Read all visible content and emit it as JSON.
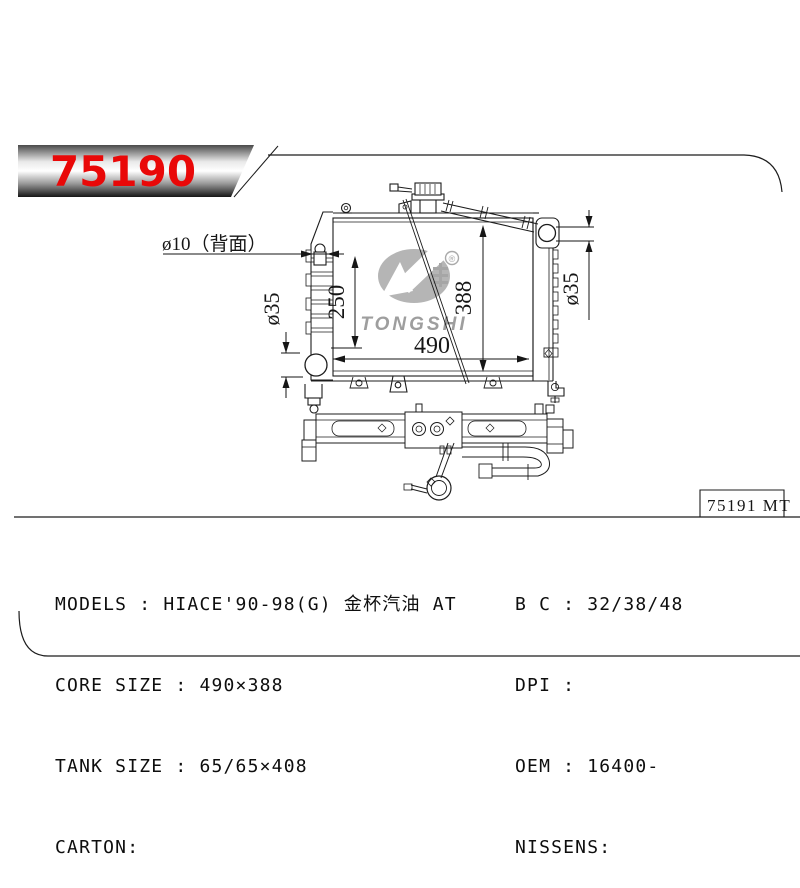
{
  "banner": {
    "part_number": "75190",
    "text_color": "#e90808"
  },
  "front_view": {
    "dimensions": {
      "rear_hole": "ø10（背面）",
      "left_height": "250",
      "core_height": "388",
      "core_width": "490",
      "inlet_diameter": "ø35",
      "outlet_diameter": "ø35"
    },
    "watermark": {
      "brand": "TONGSHI",
      "registered_mark": "®"
    }
  },
  "ref_box": {
    "label": "75191 MT"
  },
  "specs": {
    "left": [
      "MODELS : HIACE'90-98(G) 金杯汽油 AT",
      "CORE SIZE : 490×388",
      "TANK SIZE : 65/65×408",
      "CARTON:"
    ],
    "right": [
      "B C : 32/38/48",
      "DPI :",
      "OEM : 16400-",
      "NISSENS:"
    ]
  },
  "colors": {
    "line": "#1c1c1c",
    "accent_red": "#e90808",
    "watermark_gray": "#b5b5b5",
    "watermark_text_gray": "#9e9e9e"
  }
}
